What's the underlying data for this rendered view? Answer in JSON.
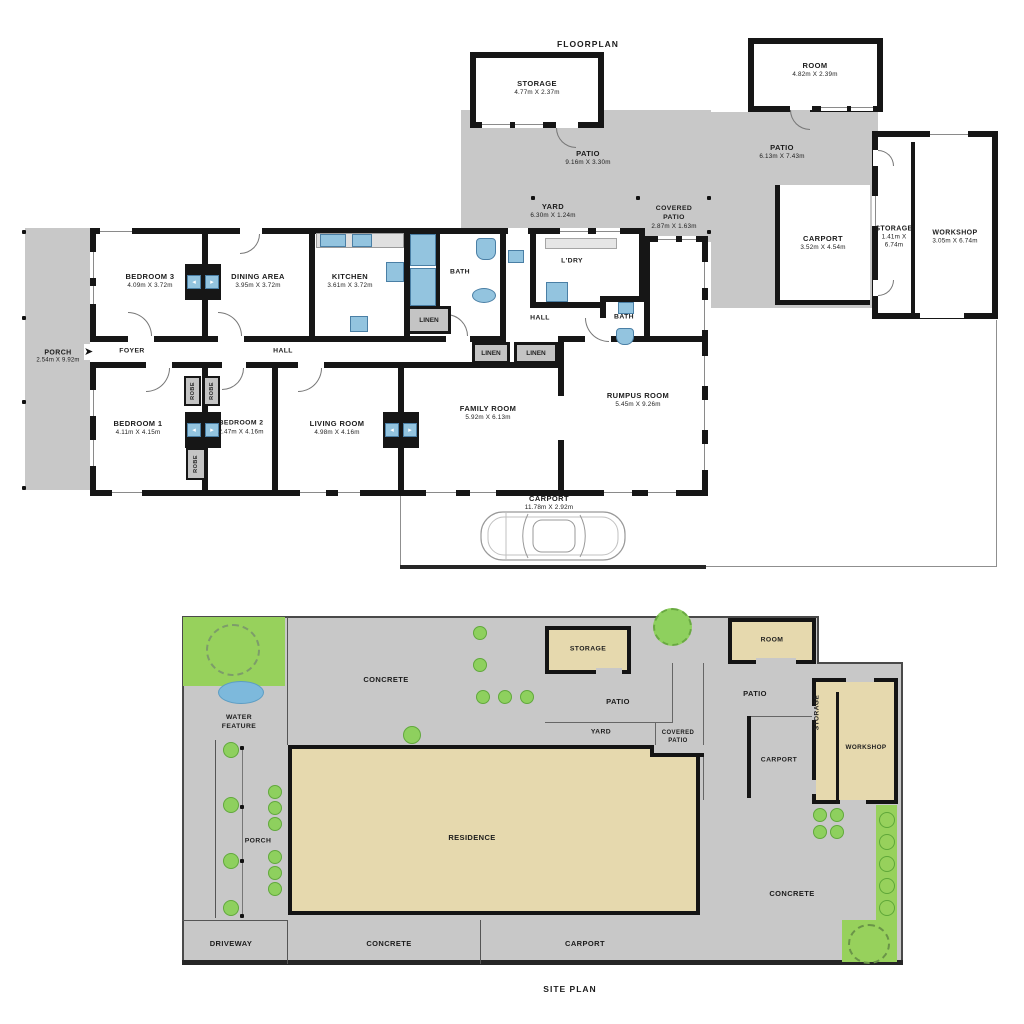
{
  "colors": {
    "wall": "#161616",
    "paving_gray": "#c8c8c8",
    "fixture_blue": "#93c4df",
    "grass_green": "#97d15c",
    "shrub_green": "#8ed05e",
    "building_tan": "#e6d9ae",
    "water_blue": "#7db9dc"
  },
  "floorplan": {
    "title": "FLOORPLAN",
    "storage_top": {
      "name": "STORAGE",
      "dims": "4.77m X 2.37m"
    },
    "room_top": {
      "name": "ROOM",
      "dims": "4.82m X 2.39m"
    },
    "patio_top": {
      "name": "PATIO",
      "dims": "9.16m X 3.30m"
    },
    "patio_right": {
      "name": "PATIO",
      "dims": "6.13m X 7.43m"
    },
    "yard": {
      "name": "YARD",
      "dims": "6.30m X 1.24m"
    },
    "covered_patio": {
      "name": "COVERED PATIO",
      "dims": "2.87m X 1.63m"
    },
    "carport_right": {
      "name": "CARPORT",
      "dims": "3.52m X 4.54m"
    },
    "storage_right": {
      "name": "STORAGE",
      "dims": "1.41m X 6.74m"
    },
    "workshop": {
      "name": "WORKSHOP",
      "dims": "3.05m X 6.74m"
    },
    "porch": {
      "name": "PORCH",
      "dims": "2.54m X 9.92m"
    },
    "bedroom3": {
      "name": "BEDROOM 3",
      "dims": "4.09m X 3.72m"
    },
    "dining": {
      "name": "DINING AREA",
      "dims": "3.95m X 3.72m"
    },
    "kitchen": {
      "name": "KITCHEN",
      "dims": "3.61m X 3.72m"
    },
    "bedroom1": {
      "name": "BEDROOM 1",
      "dims": "4.11m X 4.15m"
    },
    "bedroom2": {
      "name": "BEDROOM 2",
      "dims": "2.47m X 4.16m"
    },
    "living": {
      "name": "LIVING ROOM",
      "dims": "4.98m X 4.16m"
    },
    "family": {
      "name": "FAMILY ROOM",
      "dims": "5.92m X 6.13m"
    },
    "rumpus": {
      "name": "RUMPUS ROOM",
      "dims": "5.45m X 9.26m"
    },
    "carport_bottom": {
      "name": "CARPORT",
      "dims": "11.78m X 2.92m"
    },
    "foyer": "FOYER",
    "hall": "HALL",
    "bath": "BATH",
    "ldry": "L'DRY",
    "linen": "LINEN",
    "robe": "ROBE"
  },
  "siteplan": {
    "title": "SITE PLAN",
    "concrete": "CONCRETE",
    "water_feature": "WATER FEATURE",
    "porch": "PORCH",
    "residence": "RESIDENCE",
    "storage": "STORAGE",
    "room": "ROOM",
    "patio": "PATIO",
    "yard": "YARD",
    "covered_patio": "COVERED PATIO",
    "carport": "CARPORT",
    "workshop": "WORKSHOP",
    "driveway": "DRIVEWAY"
  }
}
